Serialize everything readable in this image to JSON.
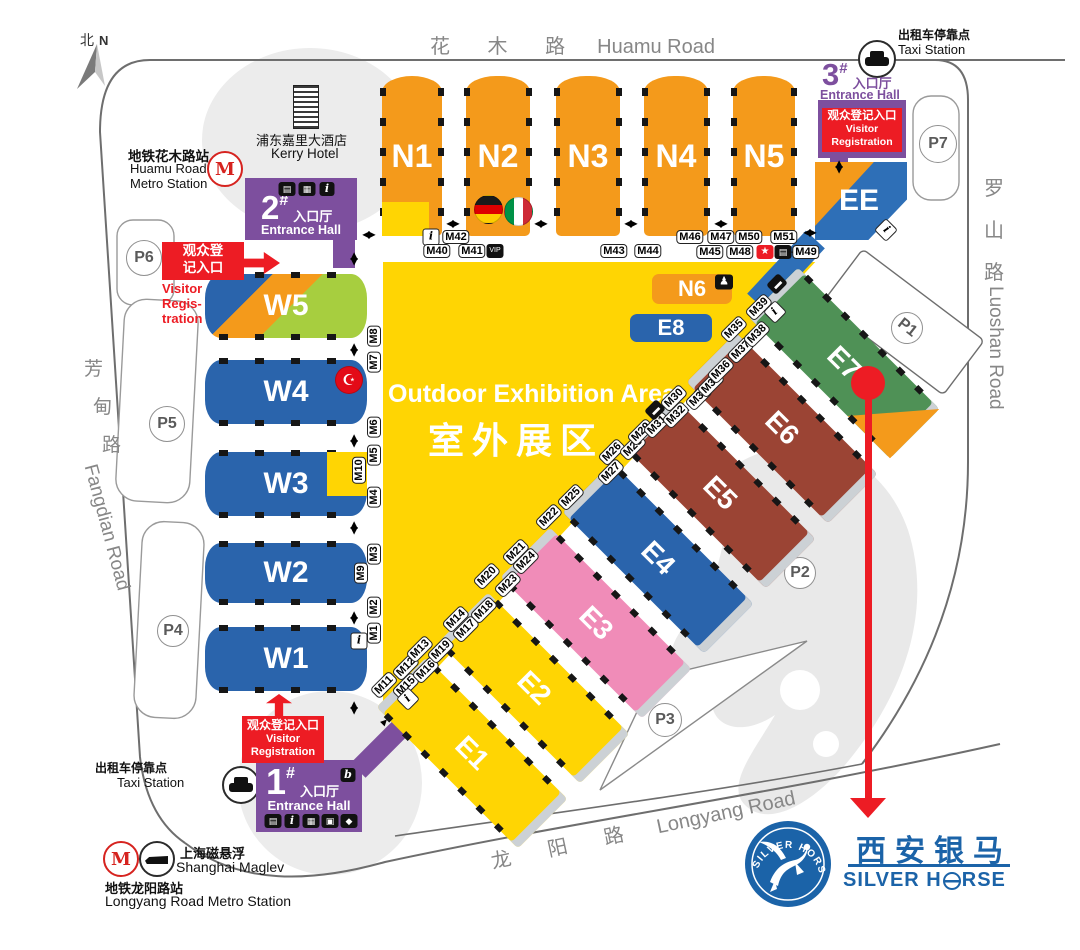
{
  "colors": {
    "hall_orange": "#F49A1B",
    "hall_yellow": "#FFD503",
    "hall_blue": "#2A64AC",
    "hall_pink": "#F08CB8",
    "hall_brown": "#9B4434",
    "hall_green": "#4F9156",
    "hall_lime": "#A7CE3F",
    "entrance_purple": "#7D4F9E",
    "alert_red": "#ED1C24",
    "logo_blue": "#1B63A8"
  },
  "compass": {
    "zh": "北",
    "en": "N"
  },
  "roads": {
    "top_zh": "花 木 路",
    "top_en": "Huamu Road",
    "right_zh": [
      "罗",
      "山",
      "路"
    ],
    "right_en": "Luoshan Road",
    "left_zh": [
      "芳",
      "甸",
      "路"
    ],
    "left_en": "Fangdian Road",
    "bottom_zh": "龙 阳 路",
    "bottom_en": "Longyang Road"
  },
  "pois": {
    "huamu_metro_zh": "地铁花木路站",
    "huamu_metro_en1": "Huamu Road",
    "huamu_metro_en2": "Metro Station",
    "kerry_zh": "浦东嘉里大酒店",
    "kerry_en": "Kerry Hotel",
    "taxi_zh": "出租车停靠点",
    "taxi_en": "Taxi Station",
    "maglev_zh": "上海磁悬浮",
    "maglev_en": "Shanghai Maglev",
    "longyang_metro_zh": "地铁龙阳路站",
    "longyang_metro_en": "Longyang Road Metro Station"
  },
  "entrances": {
    "g1": {
      "num": "1",
      "hash": "#",
      "zh": "入口厅",
      "en": "Entrance Hall"
    },
    "g2": {
      "num": "2",
      "hash": "#",
      "zh": "入口厅",
      "en": "Entrance Hall"
    },
    "g3": {
      "num": "3",
      "hash": "#",
      "zh": "入口厅",
      "en": "Entrance Hall"
    }
  },
  "registration": {
    "top_zh1": "观众登",
    "top_zh2": "记入口",
    "top_en1": "Visitor",
    "top_en2": "Regis-",
    "top_en3": "tration",
    "zh": "观众登记入口",
    "en1": "Visitor",
    "en2": "Registration"
  },
  "halls": {
    "n1": "N1",
    "n2": "N2",
    "n3": "N3",
    "n4": "N4",
    "n5": "N5",
    "n6": "N6",
    "e1": "E1",
    "e2": "E2",
    "e3": "E3",
    "e4": "E4",
    "e5": "E5",
    "e6": "E6",
    "e7": "E7",
    "e8": "E8",
    "ee": "EE",
    "w1": "W1",
    "w2": "W2",
    "w3": "W3",
    "w4": "W4",
    "w5": "W5",
    "outdoor_en": "Outdoor Exhibition Area",
    "outdoor_zh": "室外展区"
  },
  "parking": {
    "p1": "P1",
    "p2": "P2",
    "p3": "P3",
    "p4": "P4",
    "p5": "P5",
    "p6": "P6",
    "p7": "P7"
  },
  "m": [
    "M1",
    "M2",
    "M3",
    "M4",
    "M5",
    "M6",
    "M7",
    "M8",
    "M9",
    "M10",
    "M11",
    "M12",
    "M13",
    "M14",
    "M15",
    "M16",
    "M17",
    "M18",
    "M19",
    "M20",
    "M21",
    "M22",
    "M23",
    "M24",
    "M25",
    "M26",
    "M27",
    "M28",
    "M29",
    "M30",
    "M31",
    "M32",
    "M33",
    "M34",
    "M35",
    "M36",
    "M37",
    "M38",
    "M39",
    "M40",
    "M41",
    "M42",
    "M43",
    "M44",
    "M45",
    "M46",
    "M47",
    "M48",
    "M49",
    "M50",
    "M51"
  ],
  "icons": {
    "info": "i",
    "vip": "VIP",
    "star": "★",
    "b": "b",
    "book": "▤",
    "bag": "▦",
    "camera": "▣",
    "boot": "◆",
    "bus": "▬",
    "ticket": "▤",
    "figure": "♟",
    "metro": "M"
  },
  "logo": {
    "zh": "西安银马",
    "en_left": "SILVER H",
    "en_right": "RSE",
    "circle_text": "SILVER HORSE"
  }
}
